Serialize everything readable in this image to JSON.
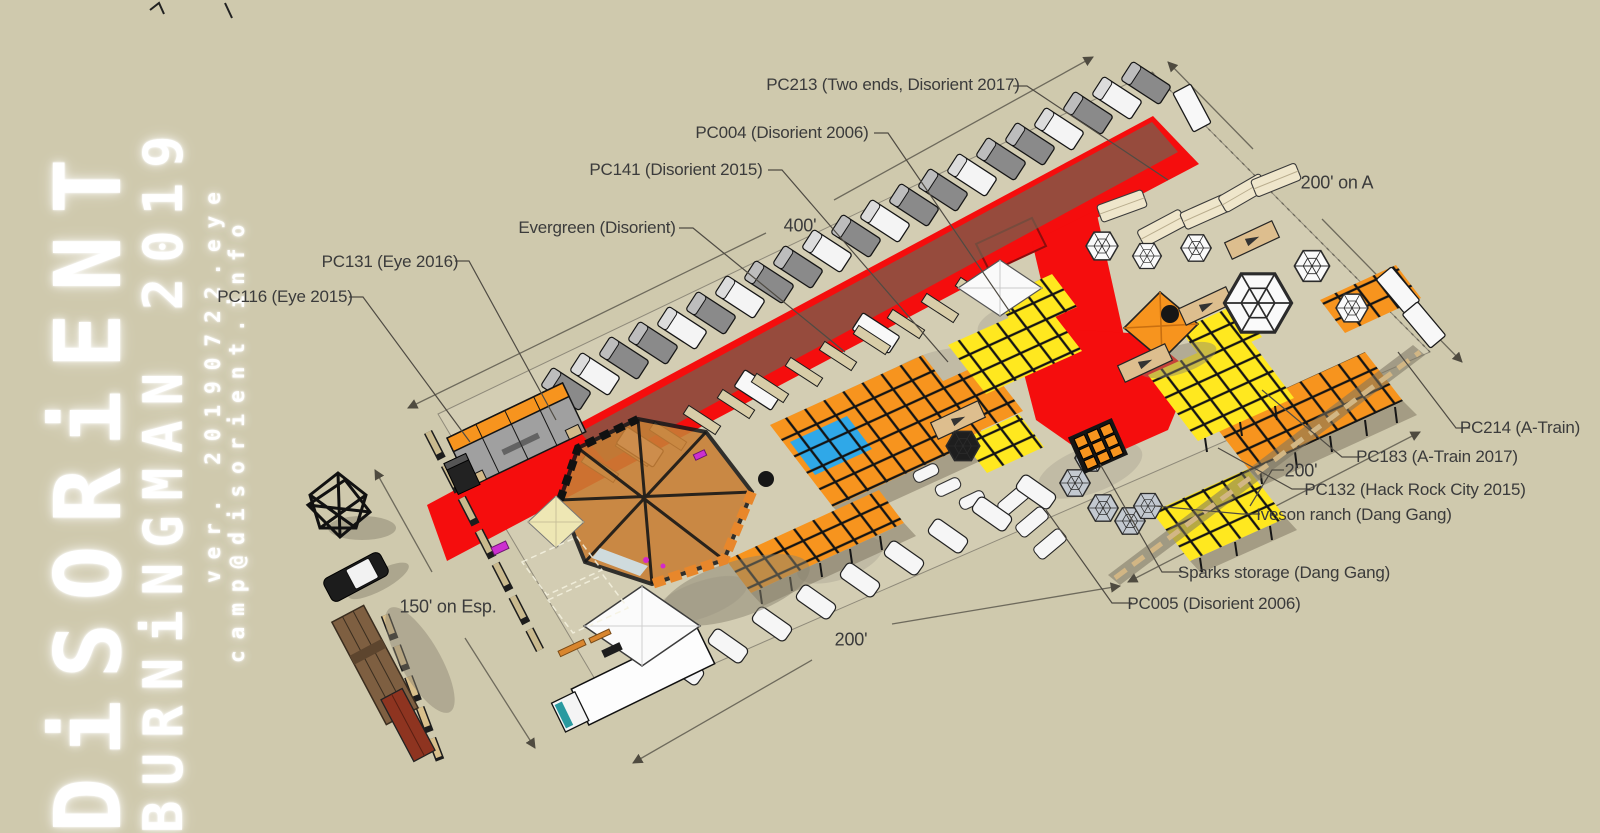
{
  "logo": {
    "line1": "DiSORiENT",
    "line2": "BURNiNGMAN 2019",
    "version": "ver. 20190722.eye",
    "email": "camp@disorient.info"
  },
  "labels": {
    "pc213": "PC213 (Two ends, Disorient 2017)",
    "pc004": "PC004 (Disorient 2006)",
    "pc141": "PC141 (Disorient 2015)",
    "evergreen": "Evergreen (Disorient)",
    "pc131": "PC131 (Eye 2016)",
    "pc116": "PC116 (Eye 2015)",
    "pc214": "PC214 (A-Train)",
    "pc183": "PC183 (A-Train 2017)",
    "pc132": "PC132 (Hack Rock City 2015)",
    "iveson": "Iveson ranch (Dang Gang)",
    "sparks": "Sparks storage (Dang Gang)",
    "pc005": "PC005 (Disorient 2006)"
  },
  "dimensions": {
    "top": "400'",
    "top_right": "200' on A",
    "bottom": "200'",
    "right": "200'",
    "esplanade": "150' on Esp."
  },
  "colors": {
    "bg": "#cfc9ad",
    "road-red": "#f50d0d",
    "grid-orange": "#f7941e",
    "grid-yellow": "#ffe81f",
    "grid-blue": "#2fa8e8",
    "label": "#3b3b3b",
    "line": "#6e6a5c",
    "beige": "#d8cda8",
    "cream": "#efe6cb",
    "dome-gray": "#c3c9d0",
    "pavilion": "#c87f35"
  }
}
